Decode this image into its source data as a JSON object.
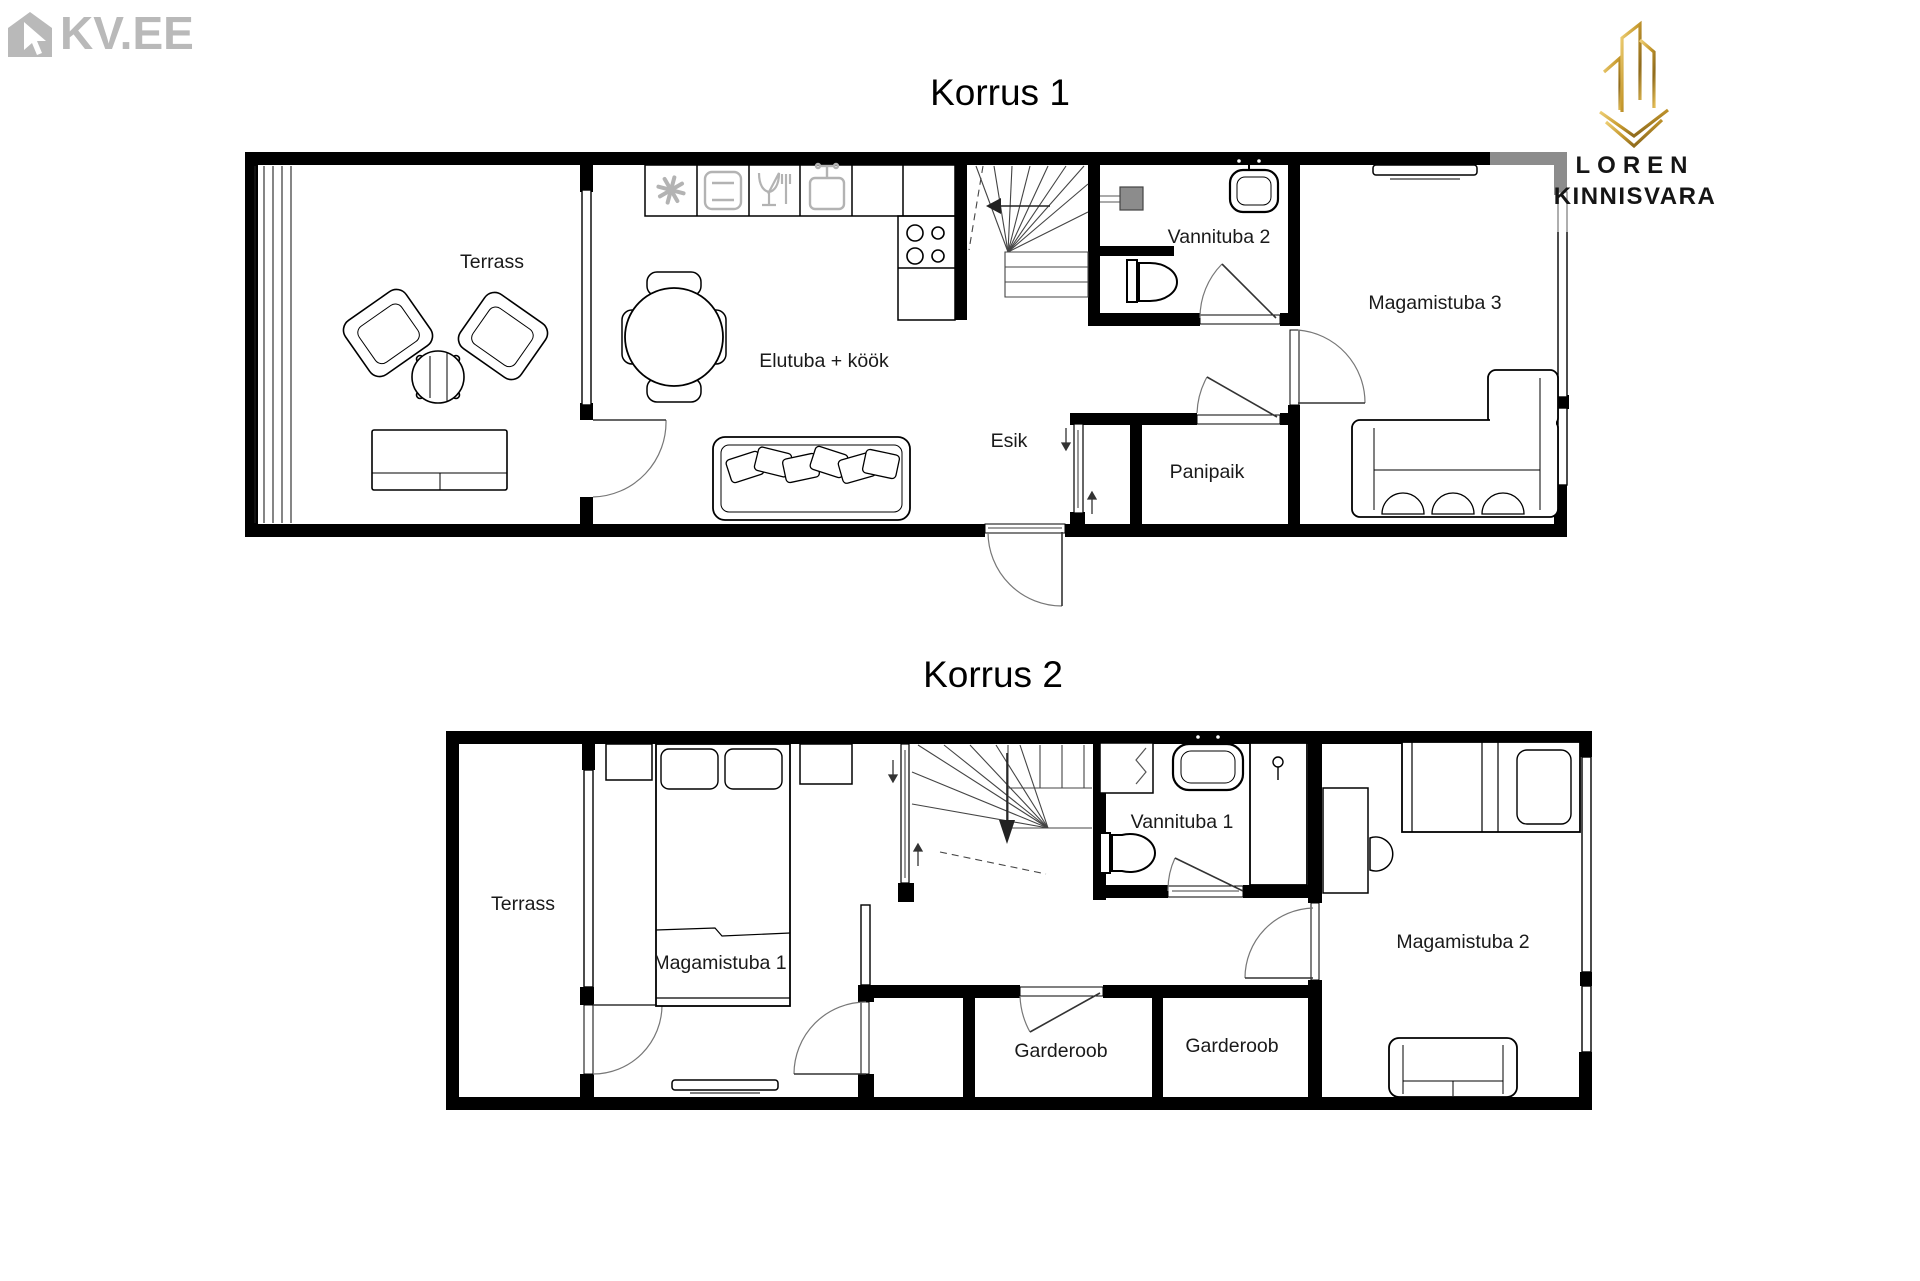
{
  "branding": {
    "kvee_logo": "KV.EE",
    "agency_logo": {
      "line1": "LOREN",
      "line2": "KINNISVARA"
    }
  },
  "floor1": {
    "title": "Korrus 1",
    "labels": {
      "terrass": "Terrass",
      "living_kitchen": "Elutuba + köök",
      "hallway": "Esik",
      "bathroom": "Vannituba 2",
      "storage": "Panipaik",
      "bedroom3": "Magamistuba 3"
    }
  },
  "floor2": {
    "title": "Korrus 2",
    "labels": {
      "terrass": "Terrass",
      "bedroom1": "Magamistuba 1",
      "bathroom": "Vannituba 1",
      "wardrobe_left": "Garderoob",
      "wardrobe_right": "Garderoob",
      "bedroom2": "Magamistuba 2"
    }
  },
  "colors": {
    "walls": "#000000",
    "kvee_gray": "#b9b9b9",
    "appliance_icon_gray": "#b3b3b3",
    "shower_gray": "#8c8c8c",
    "gold": "#c8992f",
    "label_text": "#1a1a1a"
  }
}
